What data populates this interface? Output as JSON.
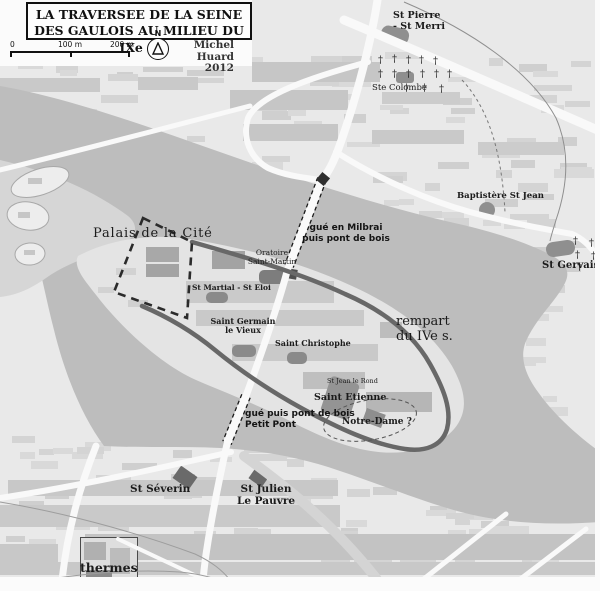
{
  "map": {
    "title": {
      "line1": "LA TRAVERSEE DE LA SEINE",
      "line2": "DES GAULOIS AU MILIEU DU IXe s."
    },
    "legend": {
      "scale_ticks": [
        "0",
        "100 m",
        "200 m"
      ],
      "north": "N",
      "credit": "Michel Huard",
      "year": "2012"
    },
    "colors": {
      "land": "#e9e9e9",
      "water": "#bdbdbd",
      "shallow": "#d6d6d6",
      "island": "#e4e4e4",
      "road": "#f9f9f9",
      "rampart": "#686868"
    },
    "labels": [
      {
        "id": "st-pierre-st-merri",
        "lines": [
          "St Pierre",
          "- St Merri"
        ],
        "x": 393,
        "y": 10,
        "size": 9.5,
        "weight": 700,
        "font": "serif"
      },
      {
        "id": "ste-colombe",
        "lines": [
          "Ste Colombe"
        ],
        "x": 372,
        "y": 83,
        "size": 8.5,
        "weight": 400,
        "font": "serif"
      },
      {
        "id": "baptistere-st-jean",
        "lines": [
          "Baptistère St Jean"
        ],
        "x": 457,
        "y": 191,
        "size": 8.5,
        "weight": 700,
        "font": "serif"
      },
      {
        "id": "st-gervais",
        "lines": [
          "St Gervais"
        ],
        "x": 542,
        "y": 260,
        "size": 10,
        "weight": 700,
        "font": "serif"
      },
      {
        "id": "palais-de-la-cite",
        "lines": [
          "Palais de la Cité"
        ],
        "x": 93,
        "y": 226,
        "size": 13,
        "weight": 400,
        "font": "serif",
        "ls": 0.8
      },
      {
        "id": "oratoire-saint-martin",
        "lines": [
          "Oratoire",
          "Saint-Martin"
        ],
        "x": 272,
        "y": 249,
        "size": 7.5,
        "weight": 400,
        "font": "serif",
        "align": "center"
      },
      {
        "id": "st-martial-st-eloi",
        "lines": [
          "St Martial - St Eloi"
        ],
        "x": 192,
        "y": 284,
        "size": 7.5,
        "weight": 700,
        "font": "serif"
      },
      {
        "id": "gue-en-milbrai",
        "lines": [
          "gué en Milbrai",
          "puis pont de bois"
        ],
        "x": 346,
        "y": 223,
        "size": 9,
        "weight": 700,
        "font": "sans",
        "align": "center"
      },
      {
        "id": "rempart-du-ive-s",
        "lines": [
          "rempart",
          "du IVe s."
        ],
        "x": 396,
        "y": 314,
        "size": 13,
        "weight": 400,
        "font": "serif"
      },
      {
        "id": "saint-germain-le-vieux",
        "lines": [
          "Saint Germain",
          "le Vieux"
        ],
        "x": 243,
        "y": 317,
        "size": 8,
        "weight": 700,
        "font": "serif",
        "align": "center"
      },
      {
        "id": "saint-christophe",
        "lines": [
          "Saint Christophe"
        ],
        "x": 275,
        "y": 339,
        "size": 8,
        "weight": 700,
        "font": "serif"
      },
      {
        "id": "st-jean-le-rond",
        "lines": [
          "St Jean le Rond"
        ],
        "x": 327,
        "y": 378,
        "size": 6.5,
        "weight": 400,
        "font": "serif"
      },
      {
        "id": "saint-etienne",
        "lines": [
          "Saint Etienne"
        ],
        "x": 314,
        "y": 392,
        "size": 9.5,
        "weight": 700,
        "font": "serif"
      },
      {
        "id": "notre-dame",
        "lines": [
          "Notre-Dame ?"
        ],
        "x": 342,
        "y": 417,
        "size": 9,
        "weight": 700,
        "font": "serif"
      },
      {
        "id": "gue-petit-pont",
        "lines": [
          "gué puis pont de bois",
          "Petit Pont"
        ],
        "x": 245,
        "y": 409,
        "size": 9,
        "weight": 700,
        "font": "sans"
      },
      {
        "id": "st-severin",
        "lines": [
          "St Séverin"
        ],
        "x": 130,
        "y": 483,
        "size": 10.5,
        "weight": 700,
        "font": "serif"
      },
      {
        "id": "st-julien-le-pauvre",
        "lines": [
          "St Julien",
          "Le Pauvre"
        ],
        "x": 266,
        "y": 483,
        "size": 10.5,
        "weight": 700,
        "font": "serif",
        "align": "center"
      },
      {
        "id": "thermes",
        "lines": [
          "thermes"
        ],
        "x": 80,
        "y": 561,
        "size": 12.5,
        "weight": 700,
        "font": "serif"
      }
    ],
    "buildings": [
      {
        "id": "block-band-st-martial",
        "x": 186,
        "y": 281,
        "w": 148,
        "h": 22,
        "fill": "#cacaca"
      },
      {
        "id": "block-band-island-1",
        "x": 196,
        "y": 310,
        "w": 168,
        "h": 16,
        "fill": "#c9c9c9"
      },
      {
        "id": "block-band-island-2",
        "x": 232,
        "y": 344,
        "w": 146,
        "h": 17,
        "fill": "#c9c9c9"
      },
      {
        "id": "block-band-island-3",
        "x": 303,
        "y": 372,
        "w": 62,
        "h": 17,
        "fill": "#bfbfbf"
      },
      {
        "id": "block-band-island-4",
        "x": 366,
        "y": 392,
        "w": 66,
        "h": 20,
        "fill": "#b6b6b6"
      },
      {
        "id": "block-band-island-5",
        "x": 380,
        "y": 322,
        "w": 22,
        "h": 16,
        "fill": "#bdbdbd"
      },
      {
        "id": "palais-building-1",
        "x": 146,
        "y": 247,
        "w": 33,
        "h": 15,
        "fill": "#a8a8a8"
      },
      {
        "id": "palais-building-2",
        "x": 146,
        "y": 264,
        "w": 33,
        "h": 13,
        "fill": "#a3a3a3"
      },
      {
        "id": "palais-building-3",
        "x": 212,
        "y": 251,
        "w": 33,
        "h": 18,
        "fill": "#a3a3a3"
      },
      {
        "id": "island-block-1",
        "x": 116,
        "y": 268,
        "w": 20,
        "h": 7,
        "fill": "#d2d2d2"
      },
      {
        "id": "island-block-2",
        "x": 98,
        "y": 287,
        "w": 16,
        "h": 6,
        "fill": "#d2d2d2"
      },
      {
        "id": "island-block-3",
        "x": 128,
        "y": 300,
        "w": 20,
        "h": 7,
        "fill": "#d0d0d0"
      },
      {
        "id": "st-pierre-st-merri-building",
        "x": 381,
        "y": 27,
        "w": 28,
        "h": 16,
        "fill": "#8f8f8f",
        "rot": 12,
        "rx": 7
      },
      {
        "id": "ste-colombe-building",
        "x": 396,
        "y": 72,
        "w": 18,
        "h": 11,
        "fill": "#8f8f8f",
        "rx": 3
      },
      {
        "id": "baptistere-building",
        "x": 479,
        "y": 202,
        "w": 16,
        "h": 16,
        "fill": "#8f8f8f",
        "rx": 8
      },
      {
        "id": "st-gervais-building",
        "x": 546,
        "y": 241,
        "w": 29,
        "h": 15,
        "fill": "#8f8f8f",
        "rot": -8,
        "rx": 7
      },
      {
        "id": "oratoire-building",
        "x": 259,
        "y": 270,
        "w": 26,
        "h": 14,
        "fill": "#7d7d7d",
        "rx": 5
      },
      {
        "id": "oratoire-gate",
        "x": 287,
        "y": 269,
        "w": 10,
        "h": 10,
        "fill": "#4f4f4f",
        "rot": 10
      },
      {
        "id": "st-martial-building",
        "x": 206,
        "y": 292,
        "w": 22,
        "h": 11,
        "fill": "#8a8a8a",
        "rx": 5
      },
      {
        "id": "st-germain-building",
        "x": 232,
        "y": 345,
        "w": 24,
        "h": 12,
        "fill": "#8a8a8a",
        "rx": 5
      },
      {
        "id": "st-christophe-building",
        "x": 287,
        "y": 352,
        "w": 20,
        "h": 12,
        "fill": "#8a8a8a",
        "rx": 5
      },
      {
        "id": "st-etienne-building",
        "x": 325,
        "y": 379,
        "w": 30,
        "h": 38,
        "fill": "#949494",
        "rot": 18,
        "rx": 4
      },
      {
        "id": "notre-dame-building",
        "x": 364,
        "y": 411,
        "w": 20,
        "h": 14,
        "fill": "#8e8e8e",
        "rot": 20
      },
      {
        "id": "st-severin-building",
        "x": 175,
        "y": 470,
        "w": 20,
        "h": 15,
        "fill": "#6a6a6a",
        "rot": 35
      },
      {
        "id": "st-julien-building",
        "x": 251,
        "y": 470,
        "w": 16,
        "h": 14,
        "fill": "#6a6a6a",
        "rot": 35
      },
      {
        "id": "thermes-complex",
        "x": 80,
        "y": 537,
        "w": 58,
        "h": 48,
        "fill": "#dedede",
        "stroke": "#4a4a4a"
      },
      {
        "id": "thermes-wing-1",
        "x": 84,
        "y": 542,
        "w": 22,
        "h": 18,
        "fill": "#b0b0b0"
      },
      {
        "id": "thermes-wing-2",
        "x": 110,
        "y": 548,
        "w": 20,
        "h": 26,
        "fill": "#bcbcbc"
      },
      {
        "id": "thermes-wing-3",
        "x": 86,
        "y": 570,
        "w": 26,
        "h": 12,
        "fill": "#8c8c8c"
      }
    ],
    "stripes": [
      {
        "x": 252,
        "y": 62,
        "w": 128,
        "h": 20,
        "fill": "#c6c6c6"
      },
      {
        "x": 138,
        "y": 77,
        "w": 60,
        "h": 13,
        "fill": "#c9c9c9"
      },
      {
        "x": 0,
        "y": 78,
        "w": 100,
        "h": 14,
        "fill": "#c9c9c9"
      },
      {
        "x": 230,
        "y": 90,
        "w": 118,
        "h": 20,
        "fill": "#c6c6c6"
      },
      {
        "x": 243,
        "y": 124,
        "w": 95,
        "h": 17,
        "fill": "#c6c6c6"
      },
      {
        "x": 382,
        "y": 92,
        "w": 78,
        "h": 12,
        "fill": "#cccccc"
      },
      {
        "x": 372,
        "y": 130,
        "w": 92,
        "h": 14,
        "fill": "#c9c9c9"
      },
      {
        "x": 478,
        "y": 142,
        "w": 86,
        "h": 13,
        "fill": "#cccccc"
      },
      {
        "x": 8,
        "y": 480,
        "w": 330,
        "h": 16,
        "fill": "#c8c8c8"
      },
      {
        "x": 0,
        "y": 505,
        "w": 340,
        "h": 22,
        "fill": "#c9c9c9"
      },
      {
        "x": 85,
        "y": 534,
        "w": 515,
        "h": 26,
        "fill": "#c3c3c3"
      },
      {
        "x": 0,
        "y": 544,
        "w": 58,
        "h": 24,
        "fill": "#c8c8c8"
      },
      {
        "x": 0,
        "y": 562,
        "w": 600,
        "h": 13,
        "fill": "#c8c8c8"
      }
    ],
    "crosses": {
      "glyph": "†",
      "positions": [
        [
          378,
          56
        ],
        [
          392,
          55
        ],
        [
          406,
          56
        ],
        [
          419,
          56
        ],
        [
          433,
          57
        ],
        [
          378,
          70
        ],
        [
          392,
          70
        ],
        [
          406,
          70
        ],
        [
          420,
          70
        ],
        [
          434,
          70
        ],
        [
          447,
          70
        ],
        [
          404,
          84
        ],
        [
          422,
          84
        ],
        [
          439,
          85
        ],
        [
          573,
          237
        ],
        [
          589,
          239
        ],
        [
          575,
          251
        ],
        [
          591,
          252
        ],
        [
          577,
          263
        ],
        [
          594,
          264
        ]
      ]
    }
  }
}
